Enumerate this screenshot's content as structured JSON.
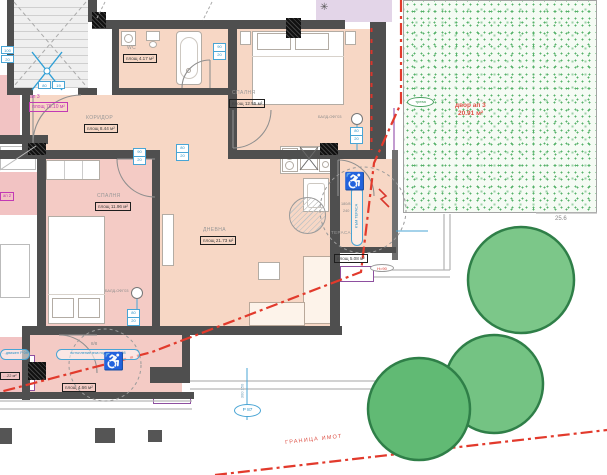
{
  "colors": {
    "wall": "#4f4f4f",
    "room_peach": "#f7d7c5",
    "room_pink": "#f4cbc5",
    "boundary_red": "#e23a2c",
    "annotation_blue": "#2b93c7",
    "apartment_magenta": "#c23ab5",
    "window_purple": "#8e4fa0",
    "grass_green": "#55b169",
    "tree_fill": "#7cc789",
    "tree_stroke": "#2f7f48"
  },
  "icons": {
    "wheelchair": "♿",
    "snowflake": "✳"
  },
  "plan": {
    "apartment": {
      "tag": "ап 3",
      "area": "площ 76.10 м²"
    },
    "rooms": {
      "corridor": {
        "name": "КОРИДОР",
        "area": "площ 8.44 м²"
      },
      "wc": {
        "name": "WC",
        "area": "площ 4.17 м²"
      },
      "bedroom_top": {
        "name": "СПАЛНЯ",
        "area": "площ 12.55 м²"
      },
      "bedroom_left": {
        "name": "СПАЛНЯ",
        "area": "площ 11.96 м²"
      },
      "living": {
        "name": "ДНЕВНА",
        "area": "площ 21.73 м²"
      },
      "terrace": {
        "name": "ТЕРАСА",
        "area": "площ 5.08 м²",
        "direction": "КЪМ ТЕРАСА",
        "dim_a": "180/8",
        "dim_b": "240",
        "height_tag": "Н=90"
      },
      "bath": {
        "area": "площ 4.66 м²",
        "dim": "8/8",
        "note": "встъпление във подвижен Р 08"
      },
      "neighbor": {
        "tag": "ап 2",
        "note": "…движен Р 09",
        "area": "…22 м²"
      }
    },
    "window_code": "БАЛД-ОФГ03",
    "door_tags": [
      {
        "top": "90",
        "bottom": "20"
      },
      {
        "top": "80",
        "bottom": "20"
      },
      {
        "top": "90",
        "bottom": "20"
      },
      {
        "top": "80",
        "bottom": "20"
      },
      {
        "top": "80",
        "bottom": "20"
      }
    ],
    "stair": {
      "dim_a": "100",
      "dim_b": "20",
      "tag_left": "80",
      "tag_right": "19"
    },
    "site": {
      "yard_label": "двор ап 3",
      "yard_area": "20.91 м²",
      "yard_dim": "25.6",
      "grass_tag": "трева",
      "boundary_label": "ГРАНИЦА ИМОТ",
      "marker": "Р 87",
      "dim_vertical": "300 150"
    }
  }
}
